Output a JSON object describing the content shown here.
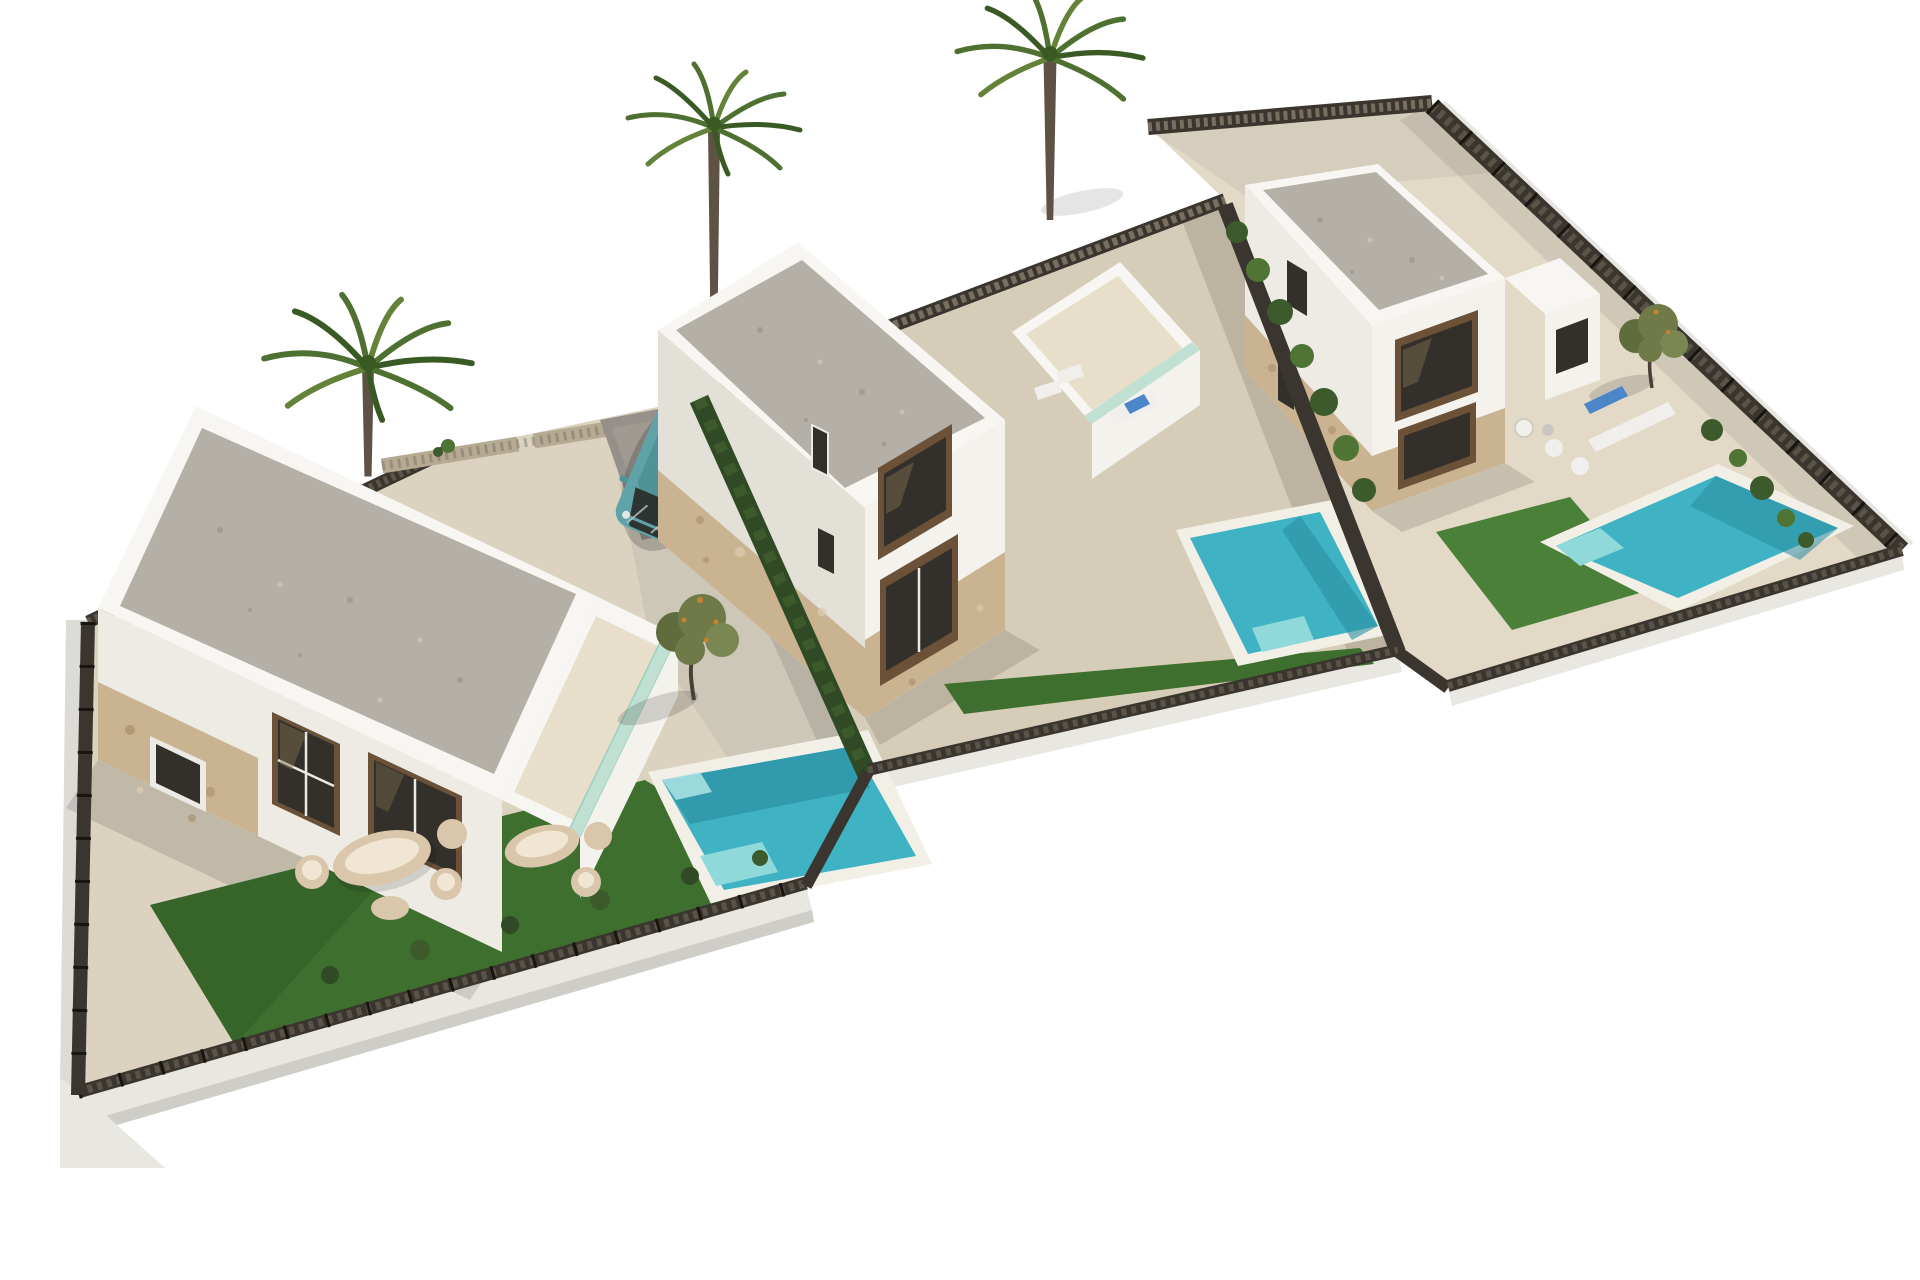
{
  "meta": {
    "title": "Aerial 3D architectural rendering",
    "subject": "Three new-build two-storey white villas on a stepped L-shaped plot, each with private pool, artificial lawn, sandstone terraces, dark mesh perimeter fencing, palm trees and a teal hatchback parked on a driveway"
  },
  "scene": {
    "background_color": "#ffffff",
    "pools": 3,
    "palm_trees": 3,
    "olive_trees": 2,
    "car": {
      "type": "hatchback",
      "color_name": "teal",
      "location": "driveway beside left villa terrace"
    },
    "parcels": [
      {
        "name": "left-parcel",
        "villa": "two-storey flat gravel roof, stone-clad plinth, roof terrace with mint glass balustrade",
        "garden": [
          "outdoor lounge set",
          "second lounge pair",
          "private pool with steps",
          "large artificial lawn",
          "olive tree",
          "driveway pad with car"
        ]
      },
      {
        "name": "middle-parcel",
        "villa": "two-storey flat gravel roof, east roof-terrace wing with sun lounger and blue towel",
        "garden": [
          "private pool with corner steps",
          "lawn strip along front fence",
          "gravel path"
        ]
      },
      {
        "name": "right-parcel",
        "villa": "two-storey flat gravel roof with side annex, stone-clad plinth",
        "garden": [
          "private pool",
          "artificial lawn",
          "two sun loungers",
          "blue lounger",
          "chair group",
          "olive tree",
          "shrub row along fence"
        ]
      }
    ],
    "fences": "dark brown mesh panels on pale concrete plinths, tan lattice street fence with gate, green hedge dividers"
  },
  "colors": {
    "bg": "#ffffff",
    "sand1": "#dbd3c0",
    "sand2": "#d6cdb8",
    "sand3": "#e2dac6",
    "pathGray": "#cbc5b7",
    "padGray": "#96908a",
    "padLight": "#a9a39b",
    "plinth": "#e9e7e2",
    "plinthShadow": "#cfcdc8",
    "sideConcrete": "#dddbd6",
    "fenceDark": "#3a352e",
    "fenceTan": "#b6aa92",
    "fenceSlat": "#756d5f",
    "fencePost": "#181511",
    "plinthLine": "#e7e6e2",
    "wallLight": "#f4f2ec",
    "wallMid": "#edebe4",
    "wallShade": "#e3e0d8",
    "parapet": "#f7f6f2",
    "gravelRoof": "#b4b0a7",
    "gravelDark": "#a19d94",
    "gravelLight": "#c6c2b9",
    "terraceFloor": "#e7dfca",
    "mintGlass": "#bfe0d2",
    "mintEdge": "#9ccfbe",
    "stone": "#c9b391",
    "stoneDark": "#a98e67",
    "stoneLight": "#dccab0",
    "frameBrown": "#6b5138",
    "glassDark": "#33302b",
    "glassSheen": "#81734f",
    "whiteFrame": "#eceae4",
    "lawn": "#3e6f2e",
    "lawnDark": "#345f27",
    "lawnLight": "#4a8038",
    "poolCoping": "#f2efe7",
    "poolWater": "#3fb3c3",
    "poolDeep": "#2a8da0",
    "poolSteps": "#8fd9da",
    "poolPale": "#b5e8e8",
    "hedge": "#2f4a25",
    "bush": "#3c5a2b",
    "bushLight": "#4f7434",
    "palmTrunk": "#5d5245",
    "palmDark": "#3a5a24",
    "palmMid": "#4e7030",
    "palmLight": "#648238",
    "oliveGreen": "#6f7a48",
    "oliveDark": "#5f6c3e",
    "oliveLight": "#7b8753",
    "oliveFruit": "#c9822e",
    "treeTrunk": "#4a4036",
    "carBody": "#5fa3a8",
    "carRoof": "#4f9298",
    "carGlass": "#2d3330",
    "carLight": "#dfe8e8",
    "carChrome": "#b9c2bf",
    "cream": "#d9c6ab",
    "creamLight": "#f0e6d3",
    "whiteFurn": "#f1efec",
    "furnStroke": "#c9c7c0",
    "towelBlue": "#4a86c8",
    "shadow": "#000000"
  }
}
